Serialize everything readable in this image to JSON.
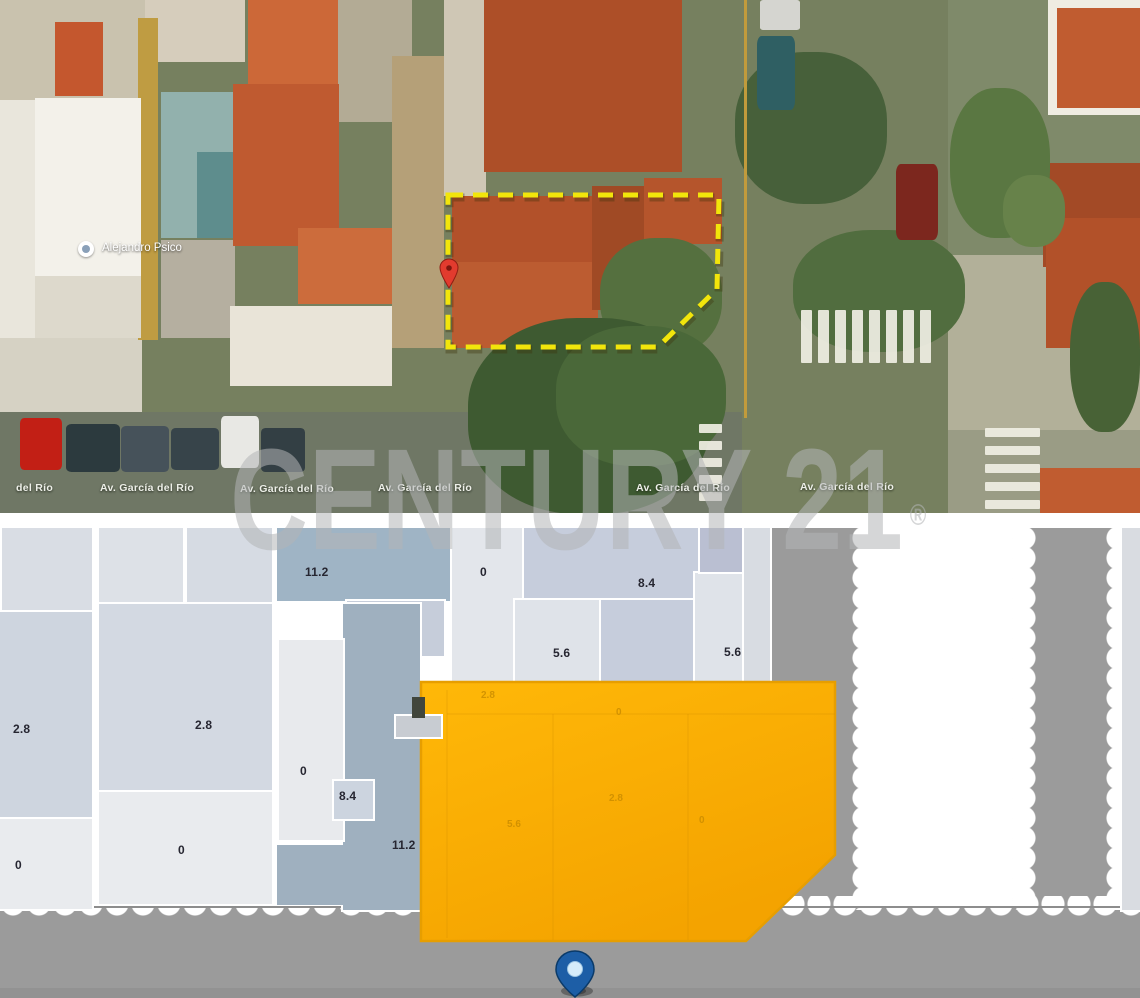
{
  "watermark": {
    "text": "CENTURY 21",
    "reg": "®"
  },
  "icons": {
    "poi-pin": "white-circle-marker",
    "red-pin": "red-teardrop-marker",
    "blue-pin": "blue-teardrop-location-marker"
  },
  "satellite": {
    "poi": {
      "label": "Alejandro Psico"
    },
    "street_labels": [
      {
        "text": "del Río",
        "x": 16,
        "y": 482
      },
      {
        "text": "Av. García del Río",
        "x": 100,
        "y": 482
      },
      {
        "text": "Av. García del Río",
        "x": 240,
        "y": 483
      },
      {
        "text": "Av. García del Río",
        "x": 378,
        "y": 482
      },
      {
        "text": "Av. García del Río",
        "x": 636,
        "y": 482
      },
      {
        "text": "Av. García del Río",
        "x": 800,
        "y": 481
      }
    ],
    "outline": {
      "points": "448,195 719,195 717,289 658,347 448,347",
      "color": "#f2e50b",
      "shadow": "rgba(60,50,10,0.35)"
    },
    "red_pin": {
      "color": "#e23b2e",
      "stroke": "#8f1d13"
    },
    "patches": [
      [
        0,
        0,
        145,
        100,
        "#c9c2ae"
      ],
      [
        145,
        0,
        100,
        62,
        "#d6cdbc"
      ],
      [
        338,
        0,
        74,
        122,
        "#b3ab95"
      ],
      [
        0,
        100,
        35,
        238,
        "#e9e6dc"
      ],
      [
        0,
        338,
        142,
        82,
        "#d6d2c4"
      ],
      [
        948,
        0,
        192,
        262,
        "#7f8a6a"
      ],
      [
        948,
        255,
        192,
        180,
        "#b2b099"
      ],
      [
        948,
        430,
        192,
        83,
        "#9a9c85"
      ],
      [
        0,
        412,
        742,
        103,
        "#6f7765"
      ],
      [
        392,
        56,
        52,
        292,
        "#b5a078"
      ],
      [
        444,
        0,
        42,
        196,
        "#cfc7b5"
      ],
      [
        138,
        18,
        20,
        322,
        "#bf9c42"
      ],
      [
        35,
        98,
        106,
        178,
        "#f3f1ea"
      ],
      [
        35,
        276,
        106,
        62,
        "#ddd9cc"
      ],
      [
        55,
        22,
        48,
        74,
        "#c4572e"
      ],
      [
        248,
        0,
        90,
        84,
        "#cc6838"
      ],
      [
        161,
        92,
        74,
        146,
        "#92b1ad"
      ],
      [
        197,
        152,
        38,
        86,
        "#5e8d8d"
      ],
      [
        161,
        240,
        74,
        98,
        "#b5afa0"
      ],
      [
        233,
        84,
        106,
        162,
        "#bf5a30"
      ],
      [
        298,
        228,
        94,
        76,
        "#cc6c3c"
      ],
      [
        230,
        306,
        162,
        80,
        "#e9e4d8"
      ],
      [
        484,
        0,
        198,
        172,
        "#ad4f28"
      ],
      [
        452,
        196,
        142,
        136,
        "#b2512a"
      ],
      [
        452,
        262,
        146,
        86,
        "#bc5c31"
      ],
      [
        592,
        186,
        76,
        124,
        "#a04a25"
      ],
      [
        644,
        178,
        78,
        66,
        "#b5552c"
      ],
      [
        1048,
        0,
        92,
        115,
        "#efece2"
      ],
      [
        1057,
        8,
        83,
        100,
        "#c05c30"
      ],
      [
        1043,
        163,
        97,
        104,
        "#a34a26"
      ],
      [
        1046,
        218,
        94,
        130,
        "#b25129"
      ],
      [
        1040,
        468,
        100,
        45,
        "#c05c30"
      ],
      [
        600,
        238,
        122,
        118,
        "#55703f",
        45
      ],
      [
        735,
        52,
        152,
        152,
        "#47603a",
        45
      ],
      [
        793,
        230,
        172,
        122,
        "#516d3f",
        45
      ],
      [
        950,
        88,
        100,
        150,
        "#5a7742",
        45
      ],
      [
        1003,
        175,
        62,
        72,
        "#67824a",
        45
      ],
      [
        1070,
        282,
        70,
        150,
        "#486236",
        45
      ],
      [
        468,
        318,
        242,
        196,
        "#3e5a31",
        45
      ],
      [
        556,
        326,
        170,
        140,
        "#4a6839",
        45
      ],
      [
        20,
        418,
        42,
        52,
        "#c21f15",
        10
      ],
      [
        66,
        424,
        54,
        48,
        "#2c3a3e",
        10
      ],
      [
        121,
        426,
        48,
        46,
        "#46525a",
        10
      ],
      [
        171,
        428,
        48,
        42,
        "#37444a",
        10
      ],
      [
        221,
        416,
        38,
        52,
        "#e8e8e4",
        10
      ],
      [
        261,
        428,
        44,
        44,
        "#333f44",
        10
      ],
      [
        757,
        36,
        38,
        74,
        "#2f5f63",
        12
      ],
      [
        896,
        164,
        42,
        76,
        "#7c271e",
        12
      ],
      [
        760,
        0,
        40,
        30,
        "#d5d5d0",
        8
      ],
      [
        744,
        0,
        3,
        418,
        "#c19b3c"
      ]
    ],
    "crosswalks": [
      {
        "x": 801,
        "y": 310,
        "count": 8,
        "w": 11,
        "h": 53,
        "sx": 17,
        "sy": 0
      },
      {
        "x": 699,
        "y": 424,
        "count": 5,
        "w": 23,
        "h": 9,
        "sx": 0,
        "sy": 17
      },
      {
        "x": 985,
        "y": 428,
        "count": 5,
        "w": 55,
        "h": 9,
        "sx": 0,
        "sy": 18
      }
    ]
  },
  "map": {
    "road_color": "#9b9b9b",
    "roads": [
      {
        "x": 0,
        "y": 908,
        "w": 1140,
        "h": 90
      },
      {
        "x": 771,
        "y": 528,
        "w": 97,
        "h": 390
      },
      {
        "x": 1025,
        "y": 528,
        "w": 93,
        "h": 390
      }
    ],
    "road_lines": [
      {
        "x": 0,
        "y": 906,
        "w": 1140,
        "h": 2,
        "c": "#8d8d8d"
      },
      {
        "x": 0,
        "y": 988,
        "w": 1140,
        "h": 10,
        "c": "#929292"
      }
    ],
    "scallops": [
      {
        "type": "v",
        "x": 852,
        "y": 528,
        "len": 382
      },
      {
        "type": "v",
        "x": 1012,
        "y": 528,
        "len": 382
      },
      {
        "type": "v",
        "x": 1106,
        "y": 528,
        "len": 382
      },
      {
        "type": "h",
        "x": 0,
        "y": 896,
        "len": 1140
      }
    ],
    "blocks": [
      {
        "x": 0,
        "y": 528,
        "w": 3,
        "h": 80,
        "c": "#c6c6c6",
        "ns": 1
      },
      {
        "x": 2,
        "y": 528,
        "w": 90,
        "h": 82,
        "c": "#d9dde4"
      },
      {
        "x": 0,
        "y": 612,
        "w": 92,
        "h": 205,
        "c": "#ced5df",
        "l": "2.8",
        "lx": 13,
        "ly": 722
      },
      {
        "x": 0,
        "y": 819,
        "w": 92,
        "h": 90,
        "c": "#e9ebee",
        "l": "0",
        "lx": 15,
        "ly": 858
      },
      {
        "x": 99,
        "y": 528,
        "w": 84,
        "h": 74,
        "c": "#dde1e7"
      },
      {
        "x": 187,
        "y": 528,
        "w": 85,
        "h": 74,
        "c": "#d6dbe3"
      },
      {
        "x": 99,
        "y": 604,
        "w": 173,
        "h": 186,
        "c": "#d3d9e2",
        "l": "2.8",
        "lx": 195,
        "ly": 718
      },
      {
        "x": 99,
        "y": 792,
        "w": 173,
        "h": 112,
        "c": "#e9ebee",
        "l": "0",
        "lx": 178,
        "ly": 843
      },
      {
        "x": 277,
        "y": 528,
        "w": 245,
        "h": 73,
        "c": "#9fb4c5",
        "l": "11.2",
        "lx": 305,
        "ly": 565
      },
      {
        "x": 347,
        "y": 601,
        "w": 97,
        "h": 55,
        "c": "#c6cdda",
        "l": "8.4",
        "lx": 388,
        "ly": 618
      },
      {
        "x": 452,
        "y": 528,
        "w": 70,
        "h": 164,
        "c": "#e3e6eb",
        "l": "0",
        "lx": 480,
        "ly": 565
      },
      {
        "x": 524,
        "y": 528,
        "w": 214,
        "h": 70,
        "c": "#c6cddc",
        "l": "8.4",
        "lx": 638,
        "ly": 576
      },
      {
        "x": 515,
        "y": 600,
        "w": 86,
        "h": 84,
        "c": "#dfe3e9",
        "l": "5.6",
        "lx": 553,
        "ly": 646
      },
      {
        "x": 601,
        "y": 600,
        "w": 92,
        "h": 84,
        "c": "#c6cddc"
      },
      {
        "x": 695,
        "y": 573,
        "w": 48,
        "h": 110,
        "c": "#dfe3e9",
        "l": "5.6",
        "lx": 724,
        "ly": 645
      },
      {
        "x": 700,
        "y": 528,
        "w": 42,
        "h": 44,
        "c": "#babfd2"
      },
      {
        "x": 744,
        "y": 528,
        "w": 26,
        "h": 155,
        "c": "#d8dce2"
      },
      {
        "x": 343,
        "y": 604,
        "w": 77,
        "h": 306,
        "c": "#9fb0bf",
        "l": "11.2",
        "lx": 392,
        "ly": 838
      },
      {
        "x": 277,
        "y": 845,
        "w": 68,
        "h": 60,
        "c": "#9fb0bf",
        "ns": 1
      },
      {
        "x": 279,
        "y": 640,
        "w": 64,
        "h": 200,
        "c": "#e8eaed",
        "l": "0",
        "lx": 300,
        "ly": 764
      },
      {
        "x": 334,
        "y": 781,
        "w": 39,
        "h": 38,
        "c": "#ccd4df",
        "l": "8.4",
        "lx": 339,
        "ly": 789
      },
      {
        "x": 1122,
        "y": 528,
        "w": 18,
        "h": 382,
        "c": "#d9dce1"
      }
    ],
    "lot": {
      "points": "421,682 835,682 835,855 746,941 421,941",
      "fill_top": "#ffb808",
      "fill_bottom": "#f4a300",
      "stroke": "#e79e00",
      "inner_lines": [
        [
          447,
          690,
          447,
          938
        ],
        [
          553,
          714,
          553,
          940
        ],
        [
          688,
          714,
          688,
          940
        ],
        [
          447,
          714,
          835,
          714
        ]
      ],
      "labels": [
        {
          "t": "2.8",
          "x": 481,
          "y": 690
        },
        {
          "t": "0",
          "x": 616,
          "y": 707
        },
        {
          "t": "2.8",
          "x": 609,
          "y": 793
        },
        {
          "t": "5.6",
          "x": 507,
          "y": 819
        },
        {
          "t": "0",
          "x": 699,
          "y": 815
        }
      ],
      "dark_rect": {
        "x": 412,
        "y": 697,
        "w": 13,
        "h": 21,
        "c": "#41463c"
      },
      "light_rect": {
        "x": 396,
        "y": 716,
        "w": 45,
        "h": 21,
        "c": "#c8ccd2"
      }
    },
    "pin": {
      "fill": "#1d5ea6",
      "stroke": "#0a3a69",
      "hole": "#d6ecfa"
    }
  }
}
